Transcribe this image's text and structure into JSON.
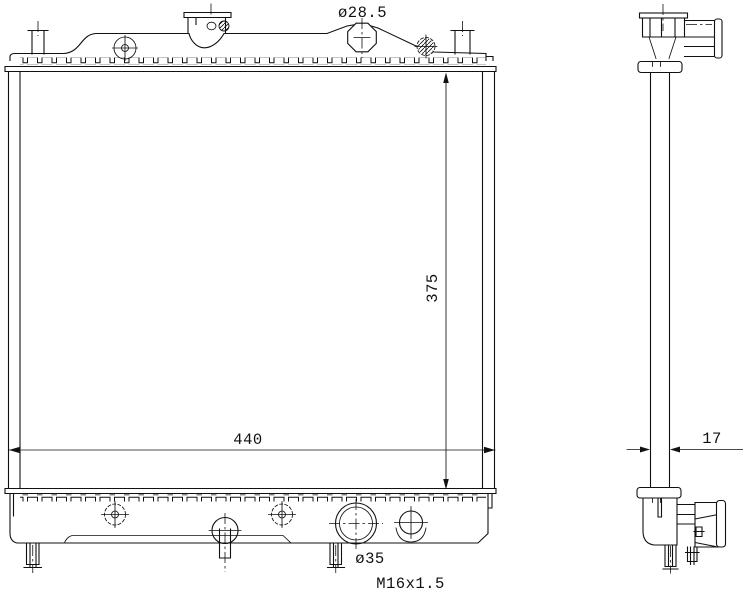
{
  "drawing": {
    "background_color": "#ffffff",
    "stroke_color": "#111111",
    "labels": {
      "filler_neck_diameter": "ø28.5",
      "core_height": "375",
      "core_width": "440",
      "core_depth": "17",
      "outlet_diameter": "ø35",
      "drain_plug_thread": "M16x1.5"
    }
  }
}
